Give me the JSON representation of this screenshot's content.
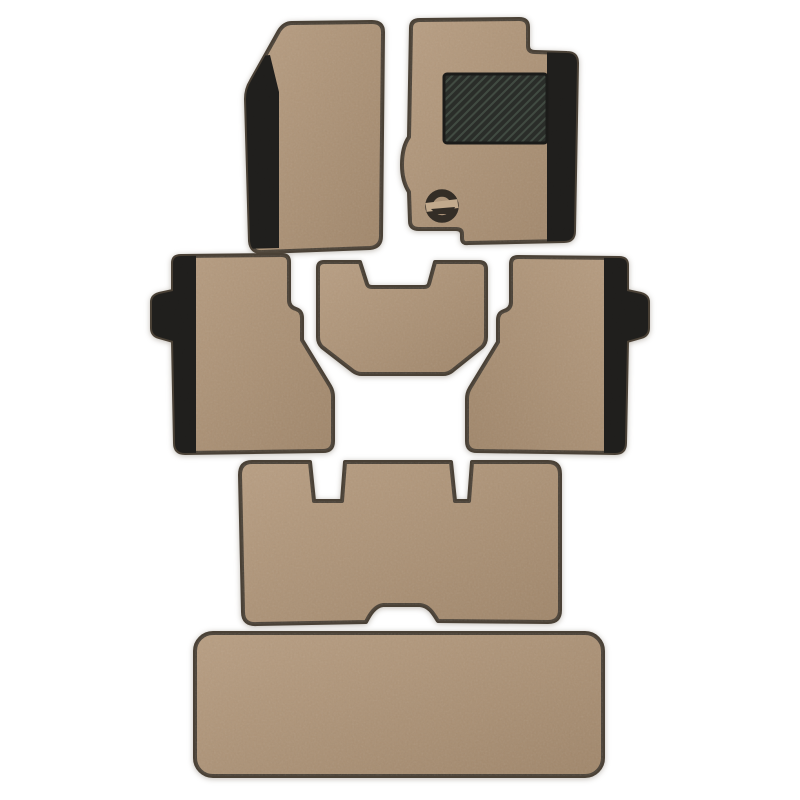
{
  "image": {
    "alt": "Seven-piece beige car floor mat set with black side trim, carbon-fiber heel pad and round logo emblem, laid out on a white background",
    "background": "#ffffff"
  },
  "colors": {
    "mat_light": "#b89e82",
    "mat_dark": "#a0866a",
    "outline": "#4a4136",
    "trim_black": "#201f1d",
    "heel_pad": "#2a2d29",
    "heel_pad_stripe": "#414b42",
    "heel_pad_border": "#1b1b19",
    "logo_dark": "#332d26",
    "logo_light": "#c2aa8d",
    "shadow": "rgba(115,104,90,0.40)"
  },
  "parts": {
    "front_left": "Front passenger floor mat",
    "front_right": "Driver floor mat with heel pad and logo",
    "middle_left": "Rear left floor mat with side tab",
    "middle_center": "Rear center tunnel mat",
    "middle_right": "Rear right floor mat with side tab",
    "bench": "Third-row bench mat with seat-mount notches",
    "boot": "Boot cargo mat",
    "heel_pad": "carbon-fiber-heel-pad",
    "logo": "round-logo-emblem"
  }
}
